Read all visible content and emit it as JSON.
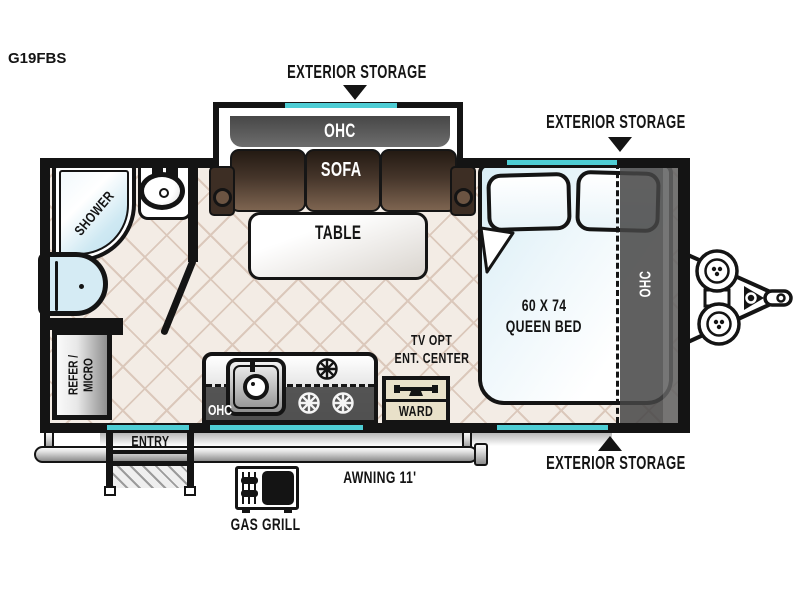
{
  "title": "G19FBS",
  "callouts": {
    "exterior_storage_top": "EXTERIOR STORAGE",
    "exterior_storage_front": "EXTERIOR STORAGE",
    "exterior_storage_bottom": "EXTERIOR STORAGE"
  },
  "living": {
    "ohc": "OHC",
    "sofa": "SOFA",
    "table": "TABLE"
  },
  "bath": {
    "shower": "SHOWER"
  },
  "storage": {
    "refer_line1": "REFER /",
    "refer_line2": "MICRO"
  },
  "galley": {
    "ohc": "OHC",
    "tv_line1": "TV OPT",
    "tv_line2": "ENT. CENTER",
    "ward": "WARD"
  },
  "bedroom": {
    "size": "60 X 74",
    "type": "QUEEN BED",
    "ohc": "OHC"
  },
  "exterior": {
    "entry": "ENTRY",
    "awning": "AWNING 11'",
    "gas_grill": "GAS GRILL"
  },
  "colors": {
    "wall": "#141414",
    "accent_teal": "#4ecdd4",
    "floor": "#f3ece5",
    "floor_line": "#dbc8bb",
    "sofa_brown": "#45352a",
    "ohc_gray": "#4f4f4f",
    "bed_blue": "#d8edf5",
    "ward_tan": "#e9e1c9"
  }
}
